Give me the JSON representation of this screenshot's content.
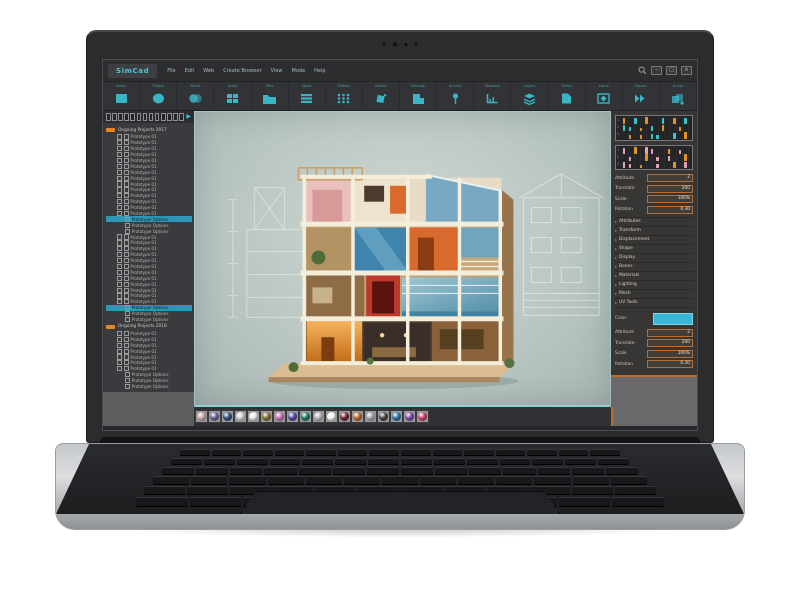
{
  "app": {
    "title": "SimCad",
    "menus": [
      "File",
      "Edit",
      "Web",
      "Create Browser",
      "View",
      "Mode",
      "Help"
    ],
    "window_controls": {
      "minimize": "–",
      "maximize": "□",
      "close": "×"
    },
    "toolbar": [
      {
        "name": "square-tool",
        "label": "Select"
      },
      {
        "name": "circle-tool",
        "label": "Ellipse"
      },
      {
        "name": "blend-tool",
        "label": "Blend"
      },
      {
        "name": "grid-tool",
        "label": "Array"
      },
      {
        "name": "folder-tool",
        "label": "Files"
      },
      {
        "name": "list-tool",
        "label": "Stack"
      },
      {
        "name": "pattern-tool",
        "label": "Pattern"
      },
      {
        "name": "rotate-tool",
        "label": "Rotate"
      },
      {
        "name": "shape-tool",
        "label": "Extrude"
      },
      {
        "name": "anchor-tool",
        "label": "Anchor"
      },
      {
        "name": "measure-tool",
        "label": "Measure"
      },
      {
        "name": "layers-tool",
        "label": "Layers"
      },
      {
        "name": "sheet-tool",
        "label": "Sheet"
      },
      {
        "name": "focus-tool",
        "label": "Focus"
      },
      {
        "name": "export-tool",
        "label": "Export"
      },
      {
        "name": "group-tool",
        "label": "Group"
      }
    ]
  },
  "sidebar": {
    "groups": [
      {
        "title": "Ongoing Projects 2017",
        "blocks": [
          {
            "items": [
              "Prototype 01",
              "Prototype 01",
              "Prototype 01",
              "Prototype 01",
              "Prototype 01",
              "Prototype 01",
              "Prototype 01",
              "Prototype 01",
              "Prototype 01",
              "Prototype 01",
              "Prototype 01",
              "Prototype 01",
              "Prototype 01",
              "Prototype 01"
            ],
            "options": [
              "Prototype Options",
              "Prototype Options",
              "Prototype Options"
            ],
            "selected_option": 0
          },
          {
            "items": [
              "Prototype 01",
              "Prototype 01",
              "Prototype 01",
              "Prototype 01",
              "Prototype 01",
              "Prototype 01",
              "Prototype 01",
              "Prototype 01",
              "Prototype 01",
              "Prototype 01",
              "Prototype 01",
              "Prototype 01"
            ],
            "options": [
              "Prototype Options",
              "Prototype Options",
              "Prototype Options"
            ],
            "selected_option": 0
          }
        ]
      },
      {
        "title": "Ongoing Projects 2018",
        "blocks": [
          {
            "items": [
              "Prototype 01",
              "Prototype 01",
              "Prototype 01",
              "Prototype 01",
              "Prototype 01",
              "Prototype 01",
              "Prototype 01"
            ],
            "options": [
              "Prototype Options",
              "Prototype Options",
              "Prototype Options"
            ],
            "selected_option": -1
          }
        ]
      }
    ]
  },
  "right_panel": {
    "sequencers": [
      {
        "rows": [
          {
            "label": "1",
            "pattern": "o.t.o..t.o.t"
          },
          {
            "label": "2",
            "pattern": "tt.o.t.o..o."
          },
          {
            "label": "3",
            "pattern": ".o.o.tt..t.o"
          }
        ]
      },
      {
        "rows": [
          {
            "label": "1",
            "pattern": "p.o.pp..o.p."
          },
          {
            "label": "2",
            "pattern": ".p..o.p.p..o"
          },
          {
            "label": "3",
            "pattern": "pp.o..p..o.p"
          }
        ]
      }
    ],
    "properties_top": [
      {
        "label": "Attribute",
        "value": "2"
      },
      {
        "label": "Translate",
        "value": "200"
      },
      {
        "label": "Scale",
        "value": "100%"
      },
      {
        "label": "Rotation",
        "value": "0.30"
      }
    ],
    "sections": [
      "Attributes",
      "Transform",
      "Displacement",
      "Shape",
      "Display",
      "Bones",
      "Materials",
      "Lighting",
      "Mesh",
      "UV Tools"
    ],
    "color_label": "Color",
    "color_value": "#3ab7d8",
    "properties_bottom": [
      {
        "label": "Attribute",
        "value": "2"
      },
      {
        "label": "Translate",
        "value": "200"
      },
      {
        "label": "Scale",
        "value": "100%"
      },
      {
        "label": "Rotation",
        "value": "0.30"
      }
    ]
  },
  "bottom_bar": {
    "material_colors": [
      "#c9a8a2",
      "#6d5a8e",
      "#2e4a7a",
      "#cfd2d4",
      "#e9eae6",
      "#7a6b33",
      "#c470ae",
      "#4e4898",
      "#177a63",
      "#b4b6b8",
      "#f2f2f0",
      "#6e1f2c",
      "#b5622a",
      "#9fa2a4",
      "#3f4144",
      "#2a6d9e",
      "#7e44a0",
      "#c33f63"
    ]
  },
  "colors": {
    "accent_teal": "#3ab5c5",
    "accent_orange": "#e8871f",
    "seq_orange": "#e8921e",
    "seq_teal": "#3fc3c3",
    "seq_pink": "#e9a0b4"
  }
}
